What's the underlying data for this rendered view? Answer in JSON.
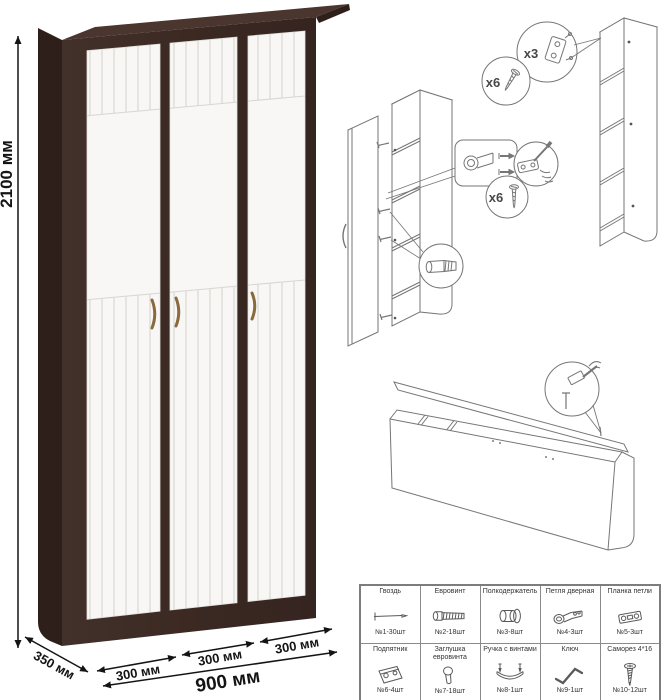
{
  "dimensions": {
    "height": "2100 мм",
    "depth": "350 мм",
    "section_1": "300 мм",
    "section_2": "300 мм",
    "section_3": "300 мм",
    "width": "900 мм"
  },
  "assembly": {
    "hinge_plate_qty": "x3",
    "screws_top_qty": "x6",
    "screws_door_qty": "x6"
  },
  "parts": [
    {
      "name": "Гвоздь",
      "qty": "№1-30шт"
    },
    {
      "name": "Евровинт",
      "qty": "№2-18шт"
    },
    {
      "name": "Полкодержатель",
      "qty": "№3-8шт"
    },
    {
      "name": "Петля дверная",
      "qty": "№4-3шт"
    },
    {
      "name": "Планка петли",
      "qty": "№5-3шт"
    },
    {
      "name": "Подпятник",
      "qty": "№6-4шт"
    },
    {
      "name": "Заглушка евровинта",
      "qty": "№7-18шт"
    },
    {
      "name": "Ручка с винтами",
      "qty": "№8-1шт"
    },
    {
      "name": "Ключ",
      "qty": "№9-1шт"
    },
    {
      "name": "Саморез 4*16",
      "qty": "№10-12шт"
    }
  ],
  "colors": {
    "frame": "#3B2922",
    "frame_top": "#4A362E",
    "frame_side": "#2E1F1A",
    "door": "#F8F7F5",
    "door_groove": "#DFDDD7",
    "handle": "#8A6A3C",
    "dimension_text": "#141414",
    "diagram_line": "#767676",
    "table_border": "#8A8A8A",
    "table_text": "#333333"
  }
}
